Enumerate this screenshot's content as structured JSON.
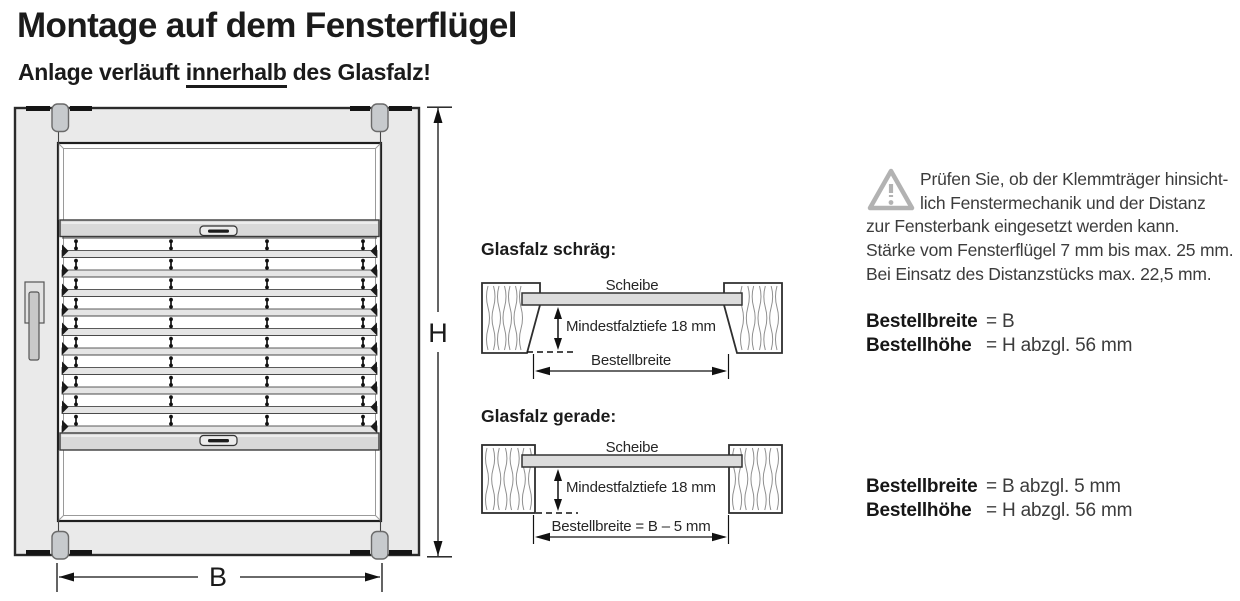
{
  "header": {
    "title": "Montage auf dem Fensterflügel",
    "subtitle_pre": "Anlage verläuft ",
    "subtitle_em": "innerhalb",
    "subtitle_post": " des Glasfalz!"
  },
  "window_diagram": {
    "height_label": "H",
    "width_label": "B"
  },
  "cross_sections": {
    "schraeg": {
      "heading": "Glasfalz schräg:",
      "pane_label": "Scheibe",
      "depth_label": "Mindestfalztiefe 18 mm",
      "width_label": "Bestellbreite"
    },
    "gerade": {
      "heading": "Glasfalz gerade:",
      "pane_label": "Scheibe",
      "depth_label": "Mindestfalztiefe 18 mm",
      "width_label": "Bestellbreite = B – 5 mm"
    }
  },
  "notice": {
    "icon": "warning-triangle-icon",
    "line1": "Prüfen Sie, ob der Klemmträger hinsicht-",
    "line2": "lich Fenstermechanik und der Distanz",
    "line3": "zur Fensterbank eingesetzt werden kann.",
    "line4": "Stärke vom Fensterflügel 7 mm bis max. 25 mm.",
    "line5": "Bei Einsatz des Distanzstücks max. 22,5 mm."
  },
  "order_schraeg": {
    "width_label": "Bestellbreite",
    "width_value": "= B",
    "height_label": "Bestellhöhe",
    "height_value": "= H abzgl. 56 mm"
  },
  "order_gerade": {
    "width_label": "Bestellbreite",
    "width_value": "= B abzgl. 5 mm",
    "height_label": "Bestellhöhe",
    "height_value": "= H abzgl. 56 mm"
  },
  "colors": {
    "frame_fill": "#eaeaea",
    "rail_fill": "#d9d9d9",
    "bracket_fill": "#c7cacd",
    "pane_bar_fill": "#dcdcdc",
    "warning_icon_gray": "#b2b2b2",
    "line_dark": "#1b1b1b"
  }
}
